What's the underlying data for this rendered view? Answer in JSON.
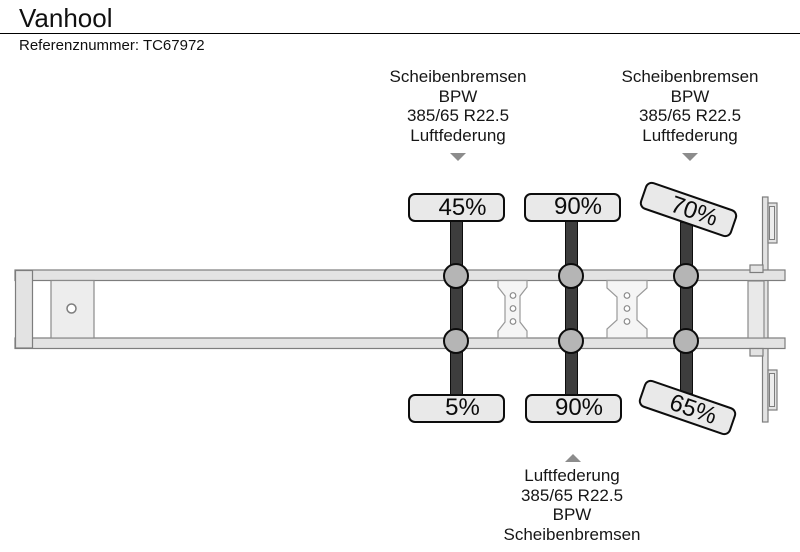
{
  "header": {
    "title": "Vanhool",
    "reference": "Referenznummer: TC67972"
  },
  "spec_blocks": {
    "top_left": {
      "lines": [
        "Scheibenbremsen",
        "BPW",
        "385/65 R22.5",
        "Luftfederung"
      ]
    },
    "top_right": {
      "lines": [
        "Scheibenbremsen",
        "BPW",
        "385/65 R22.5",
        "Luftfederung"
      ]
    },
    "bottom": {
      "lines": [
        "Luftfederung",
        "385/65 R22.5",
        "BPW",
        "Scheibenbremsen"
      ]
    }
  },
  "axles": [
    {
      "name": "axle-1",
      "top_tread": "45%",
      "bottom_tread": "5%"
    },
    {
      "name": "axle-2",
      "top_tread": "90%",
      "bottom_tread": "90%"
    },
    {
      "name": "axle-3",
      "top_tread": "70%",
      "bottom_tread": "65%"
    }
  ],
  "colors": {
    "axle_bar": "#3d3d3d",
    "hub": "#b5b5b5",
    "chassis_fill": "#e3e3e3",
    "chassis_stroke": "#7d7d7d",
    "label_fill": "#e9e9e9",
    "label_border": "#0d0d0d",
    "arrow": "#8c8c8c",
    "text": "#101010"
  }
}
